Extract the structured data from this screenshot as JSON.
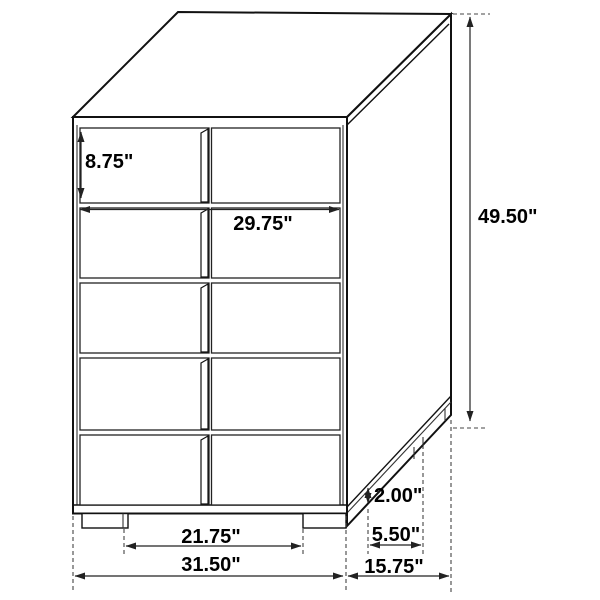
{
  "diagram": {
    "object": "chest-of-drawers",
    "drawer_rows": 5,
    "drawer_columns": 2,
    "units": "inches"
  },
  "dims": {
    "top_drawer_height": "8.75\"",
    "front_inner_width": "29.75\"",
    "overall_height": "49.50\"",
    "base_height": "2.00\"",
    "side_leg_spacing": "5.50\"",
    "overall_depth": "15.75\"",
    "front_leg_spacing": "21.75\"",
    "overall_width": "31.50\""
  }
}
